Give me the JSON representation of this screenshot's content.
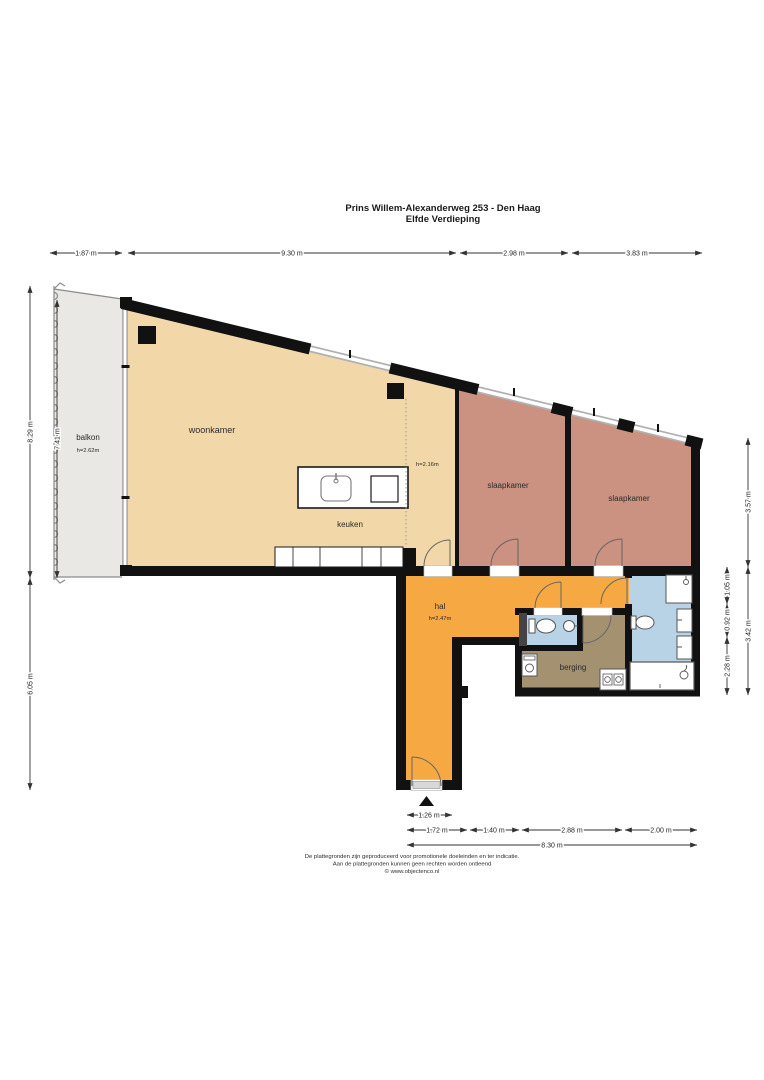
{
  "title": {
    "line1": "Prins Willem-Alexanderweg 253 - Den Haag",
    "line2": "Elfde Verdieping"
  },
  "rooms": {
    "balkon": {
      "name": "balkon",
      "ceiling": "h=2.62m"
    },
    "woonkamer": {
      "name": "woonkamer"
    },
    "keuken": {
      "name": "keuken",
      "ceiling_zone": "h=2.16m"
    },
    "slaapkamer_links": {
      "name": "slaapkamer"
    },
    "slaapkamer_rechts": {
      "name": "slaapkamer"
    },
    "hal": {
      "name": "hal",
      "ceiling": "h=2.47m"
    },
    "berging": {
      "name": "berging"
    }
  },
  "dimensions": {
    "top": [
      "1.87 m",
      "9.30 m",
      "2.98 m",
      "3.83 m"
    ],
    "left": [
      "8.29 m",
      "7.41 m",
      "6.05 m"
    ],
    "right_outer": [
      "3.57 m",
      "3.42 m"
    ],
    "right_inner": [
      "1.05 m",
      "0.92 m",
      "2.28 m"
    ],
    "bottom_row1": [
      "1.26 m"
    ],
    "bottom_row2": [
      "1.72 m",
      "1.40 m",
      "2.88 m",
      "2.00 m"
    ],
    "bottom_total": "8.30 m"
  },
  "footer": {
    "line1": "De plattegronden zijn geproduceerd voor promotionele doeleinden en ter indicatie.",
    "line2": "Aan de plattegronden kunnen geen rechten worden ontleend",
    "line3": "© www.objectenco.nl"
  },
  "colors": {
    "woonkamer": "#f2d8a8",
    "slaapkamer": "#cb9181",
    "hal": "#f6a942",
    "berging": "#a3916f",
    "sanitair": "#b9d3e6",
    "balkon": "#e9e8e4",
    "wall": "#111111"
  }
}
